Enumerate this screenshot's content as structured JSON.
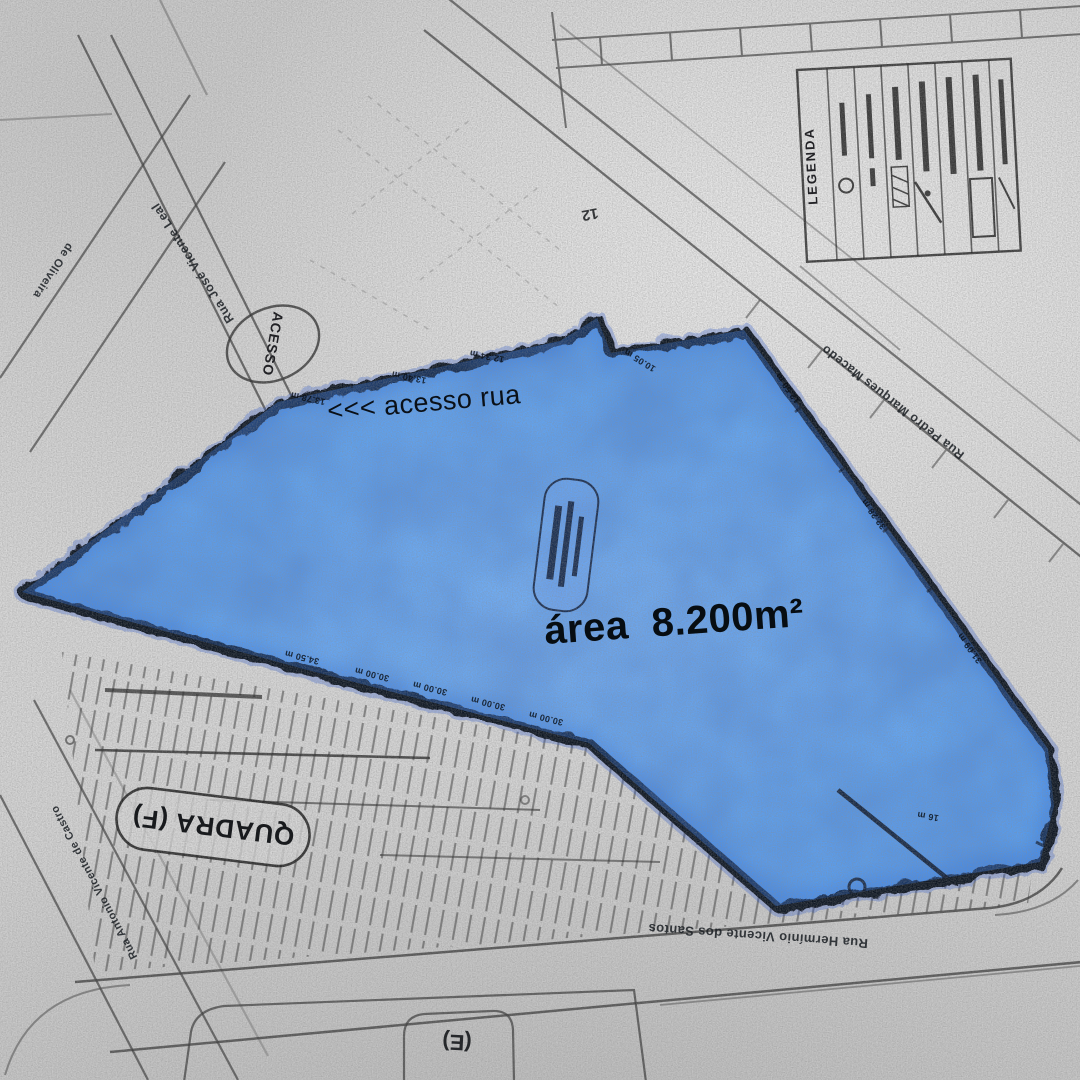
{
  "parcel": {
    "area_label": "área  8.200m²",
    "access_note": "<<< acesso rua"
  },
  "stamps": {
    "acesso": "ACESSO",
    "quadra_f": "QUADRA (F)",
    "quadra_e": "(E)",
    "lot_number": "12"
  },
  "legend": {
    "title": "LEGENDA"
  },
  "streets": {
    "jose_vicente_leal": "Rua José Vicente Leal",
    "de_oliveira": "de Oliveira",
    "pedro_marques": "Rua Pedro Marques Macedo",
    "herminio": "Rua Hermínio Vicente dos Santos",
    "antonio": "Rua Antonio Vicente de Castro"
  },
  "measurements": [
    "13.78 m",
    "13.40 m",
    "12.34 m",
    "34.50 m",
    "30.00 m",
    "30.00 m",
    "30.00 m",
    "30.00 m",
    "32.28 m",
    "31.09 m",
    "10.05 m",
    "16 m",
    "12.50 m"
  ],
  "colors": {
    "parcel_fill": "#5fa3f2",
    "parcel_border": "#0a1222",
    "paper": "#d7d7d7",
    "ink": "#3c3c3c"
  }
}
